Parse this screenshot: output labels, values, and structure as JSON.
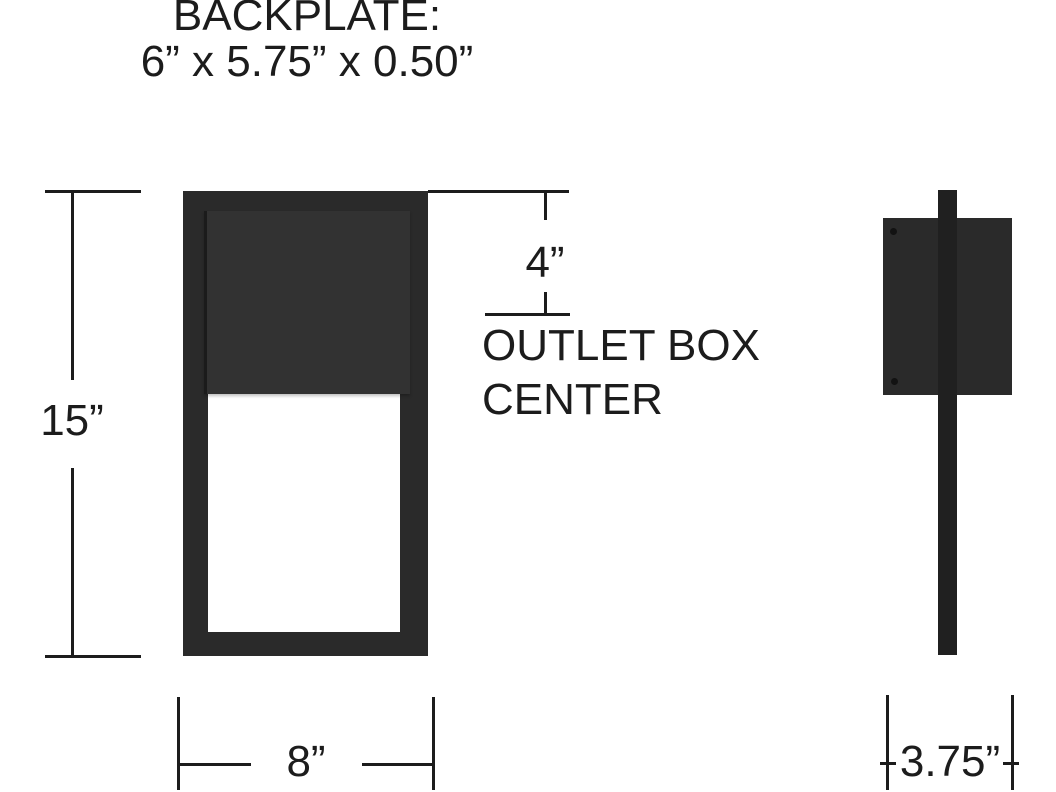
{
  "title": {
    "line1": "BACKPLATE:",
    "line2": "6” x 5.75” x 0.50”"
  },
  "dimensions": {
    "height": "15”",
    "width": "8”",
    "outlet_offset": "4”",
    "outlet_caption_line1": "OUTLET BOX",
    "outlet_caption_line2": "CENTER",
    "depth": "3.75”"
  },
  "colors": {
    "background": "#ffffff",
    "fixture": "#2a2a2a",
    "panel": "#323232",
    "bar": "#202020",
    "diffuser": "#ffffff",
    "line": "#1c1c1c",
    "text": "#1c1c1c"
  }
}
